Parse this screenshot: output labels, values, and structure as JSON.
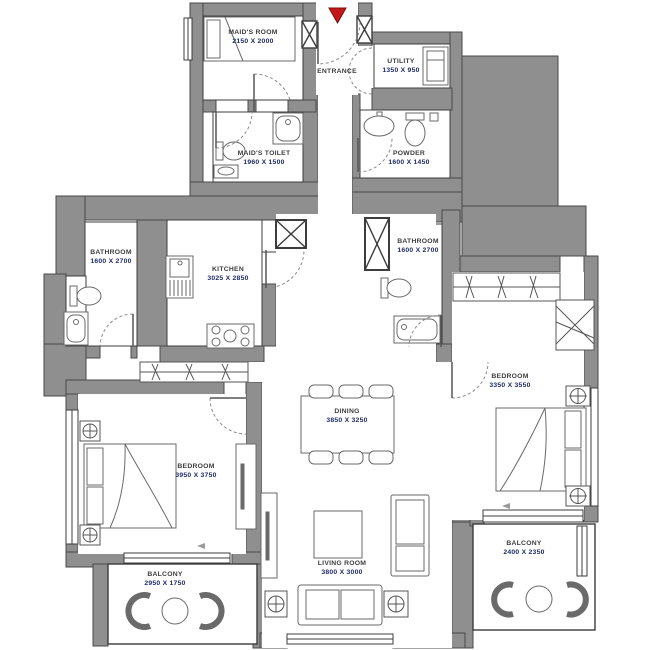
{
  "plan": {
    "title": "Apartment floor plan",
    "colors": {
      "wall": "#8f8f8f",
      "line": "#3c3c3c",
      "room_name": "#3d3d3d",
      "dimension": "#1e2a68",
      "entrance_marker": "#c41818"
    },
    "entrance_marker_icon": "triangle-down-red",
    "rooms": [
      {
        "id": "maids-room",
        "name": "MAID'S ROOM",
        "dimensions": "2150 X 2000"
      },
      {
        "id": "entrance",
        "name": "ENTRANCE",
        "dimensions": ""
      },
      {
        "id": "utility",
        "name": "UTILITY",
        "dimensions": "1350 X 950"
      },
      {
        "id": "maids-toilet",
        "name": "MAID'S TOILET",
        "dimensions": "1960 X 1500"
      },
      {
        "id": "powder",
        "name": "POWDER",
        "dimensions": "1600 X 1450"
      },
      {
        "id": "bathroom-left",
        "name": "BATHROOM",
        "dimensions": "1600 X 2700"
      },
      {
        "id": "kitchen",
        "name": "KITCHEN",
        "dimensions": "3025 X 2850"
      },
      {
        "id": "bathroom-right",
        "name": "BATHROOM",
        "dimensions": "1600 X 2700"
      },
      {
        "id": "bedroom-right",
        "name": "BEDROOM",
        "dimensions": "3350 X 3550"
      },
      {
        "id": "dining",
        "name": "DINING",
        "dimensions": "3850 X 3250"
      },
      {
        "id": "bedroom-left",
        "name": "BEDROOM",
        "dimensions": "3950 X 3750"
      },
      {
        "id": "living-room",
        "name": "LIVING ROOM",
        "dimensions": "3800 X 3000"
      },
      {
        "id": "balcony-left",
        "name": "BALCONY",
        "dimensions": "2950 X 1750"
      },
      {
        "id": "balcony-right",
        "name": "BALCONY",
        "dimensions": "2400 X 2350"
      }
    ]
  }
}
